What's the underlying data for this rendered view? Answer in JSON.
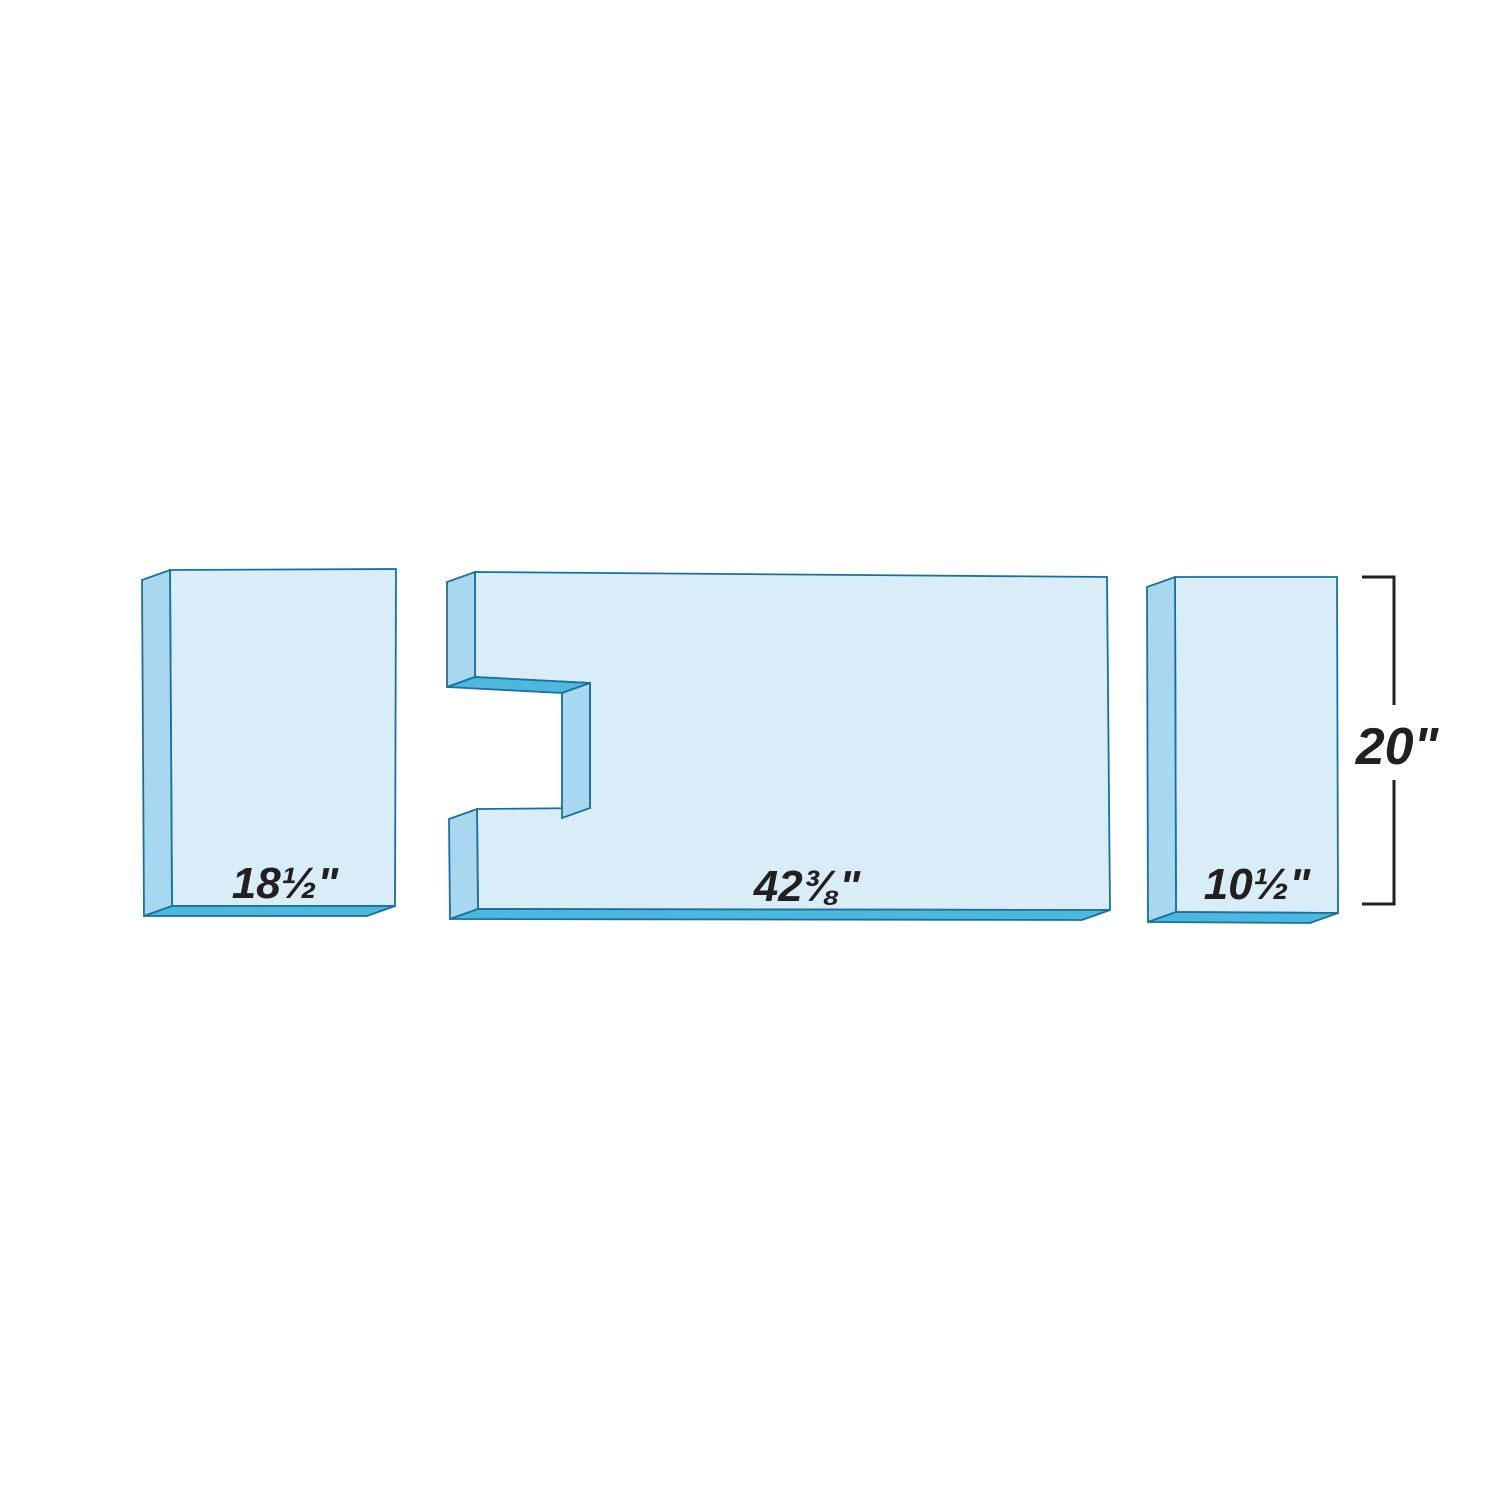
{
  "diagram": {
    "pieces": [
      {
        "id": "left",
        "width_label": "18½\""
      },
      {
        "id": "center",
        "width_label": "42⅜\""
      },
      {
        "id": "right",
        "width_label": "10½\""
      }
    ],
    "height_label": "20\"",
    "colors": {
      "front_face": "#d9edf8",
      "side_face": "#a7d8ef",
      "bottom_face": "#4cb8dd",
      "outline": "#1b6fa0",
      "dimension": "#231f20"
    }
  }
}
